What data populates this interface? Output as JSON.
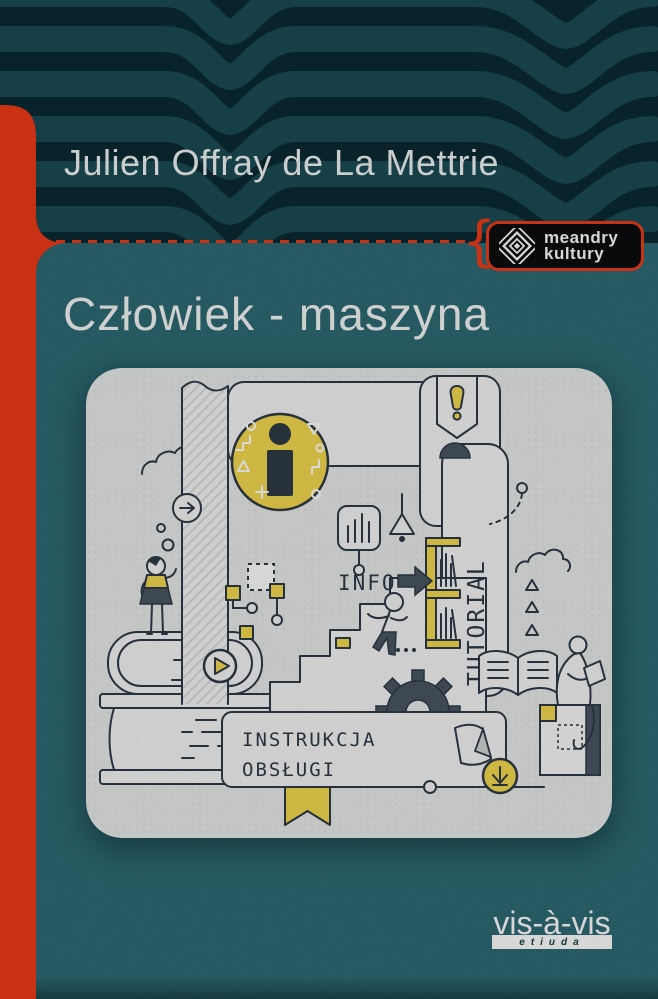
{
  "colors": {
    "red": "#ee3a18",
    "teal": "#2e6a73",
    "header": "#0a2a31",
    "band": "#1d4f59",
    "yellow": "#f2d84e",
    "ink": "#2e3a46",
    "panel": "#e8eae9",
    "paper": "#f3f4f3",
    "slate": "#4a5663"
  },
  "header": {
    "author": "Julien Offray de La Mettrie"
  },
  "badge": {
    "line1": "meandry",
    "line2": "kultury",
    "icon": "concentric-diamond-icon"
  },
  "title": "Człowiek - maszyna",
  "illustration": {
    "labels": {
      "info": "INFO",
      "tutorial": "TUTORIAL",
      "manual_line1": "INSTRUKCJA",
      "manual_line2": "OBSŁUGI"
    },
    "icons": [
      "info-icon",
      "exclamation-icon",
      "arrow-right-icon",
      "play-icon",
      "download-arrow-icon",
      "gear-icon",
      "open-book-icon",
      "bookshelf-icon",
      "lamp-icon",
      "bar-chart-icon",
      "cloud",
      "stairs",
      "book-stack",
      "standing-person",
      "climbing-person",
      "reading-person",
      "ribbon-bookmark",
      "folded-paper",
      "flowchart-nodes",
      "triangle-marks"
    ]
  },
  "imprint": {
    "name": "vis-à-vis",
    "sub": "etiuda"
  }
}
